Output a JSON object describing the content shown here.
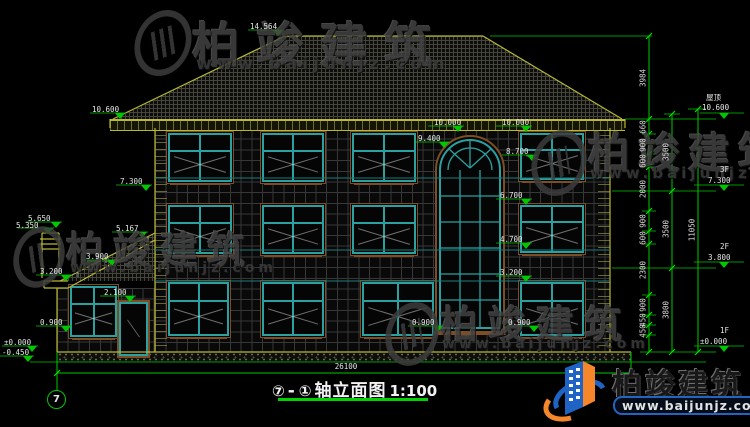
{
  "watermark": {
    "brand": "柏竣建筑",
    "site": "www.baijunjz.com"
  },
  "logo": {
    "brand": "柏竣建筑",
    "site": "www.baijunjz.com"
  },
  "title": {
    "axis_from": "⑦",
    "sep": "-",
    "axis_to": "①",
    "name": "轴立面图",
    "scale": "1:100"
  },
  "axis_bubble_left": "7",
  "dims": {
    "total": "26100",
    "right_inner": [
      "3984",
      "660",
      "900",
      "600",
      "2000",
      "900",
      "600",
      "2300",
      "900",
      "450",
      "450"
    ],
    "right_mid": [
      "3500",
      "3500",
      "3800"
    ],
    "right_outer": [
      "11050"
    ]
  },
  "levels": {
    "left": [
      "14.564",
      "10.600",
      "7.300",
      "5.650",
      "5.350",
      "5.167",
      "3.900",
      "3.200",
      "2.100",
      "0.900",
      "±0.000",
      "-0.450"
    ],
    "center": [
      "10.000",
      "10.000",
      "9.400",
      "8.700",
      "6.700",
      "4.700",
      "3.200",
      "0.900",
      "0.900"
    ]
  },
  "floors": [
    {
      "name": "屋顶",
      "elev": "10.600"
    },
    {
      "name": "3F",
      "elev": "7.300"
    },
    {
      "name": "2F",
      "elev": "3.800"
    },
    {
      "name": "1F",
      "elev": "±0.000"
    }
  ]
}
